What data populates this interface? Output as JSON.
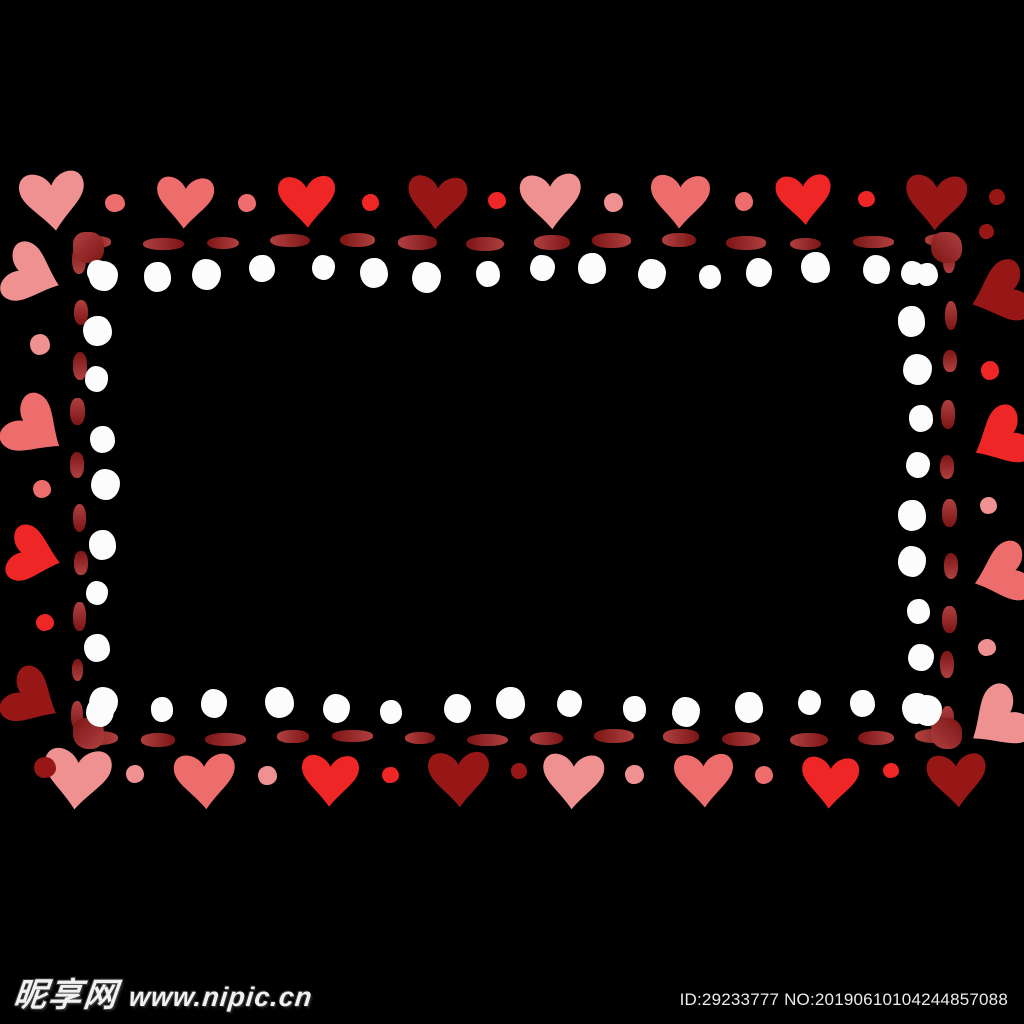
{
  "canvas": {
    "width": 1024,
    "height": 1024,
    "background": "#000000"
  },
  "palette": {
    "pink": "#f09191",
    "salmon": "#ed6c6c",
    "red": "#ee2626",
    "darkred": "#971717",
    "dash_light": "#b04040",
    "dash_dark": "#7c1515",
    "white_dot": "#fcfcfc"
  },
  "frame": {
    "hearts": [
      {
        "x": 53,
        "y": 202,
        "s": 66,
        "r": -6,
        "c": "pink"
      },
      {
        "x": 185,
        "y": 203,
        "s": 58,
        "r": 3,
        "c": "salmon"
      },
      {
        "x": 307,
        "y": 202,
        "s": 58,
        "r": -2,
        "c": "red"
      },
      {
        "x": 437,
        "y": 203,
        "s": 60,
        "r": 4,
        "c": "darkred"
      },
      {
        "x": 551,
        "y": 202,
        "s": 62,
        "r": -3,
        "c": "pink"
      },
      {
        "x": 680,
        "y": 202,
        "s": 60,
        "r": 2,
        "c": "salmon"
      },
      {
        "x": 804,
        "y": 200,
        "s": 56,
        "r": -4,
        "c": "red"
      },
      {
        "x": 936,
        "y": 203,
        "s": 62,
        "r": 3,
        "c": "darkred"
      },
      {
        "x": 77,
        "y": 780,
        "s": 68,
        "r": 5,
        "c": "pink"
      },
      {
        "x": 205,
        "y": 782,
        "s": 62,
        "r": -3,
        "c": "salmon"
      },
      {
        "x": 330,
        "y": 781,
        "s": 58,
        "r": 2,
        "c": "red"
      },
      {
        "x": 459,
        "y": 780,
        "s": 62,
        "r": -2,
        "c": "darkred"
      },
      {
        "x": 573,
        "y": 782,
        "s": 62,
        "r": 3,
        "c": "pink"
      },
      {
        "x": 704,
        "y": 781,
        "s": 60,
        "r": -2,
        "c": "salmon"
      },
      {
        "x": 830,
        "y": 783,
        "s": 58,
        "r": 3,
        "c": "red"
      },
      {
        "x": 957,
        "y": 781,
        "s": 60,
        "r": -4,
        "c": "darkred"
      },
      {
        "x": 33,
        "y": 276,
        "s": 62,
        "r": -70,
        "c": "pink"
      },
      {
        "x": 36,
        "y": 430,
        "s": 64,
        "r": -55,
        "c": "salmon"
      },
      {
        "x": 35,
        "y": 556,
        "s": 58,
        "r": -75,
        "c": "red"
      },
      {
        "x": 33,
        "y": 700,
        "s": 60,
        "r": -60,
        "c": "darkred"
      },
      {
        "x": 999,
        "y": 295,
        "s": 64,
        "r": 70,
        "c": "darkred"
      },
      {
        "x": 1000,
        "y": 440,
        "s": 62,
        "r": 62,
        "c": "red"
      },
      {
        "x": 1001,
        "y": 575,
        "s": 62,
        "r": 72,
        "c": "salmon"
      },
      {
        "x": 997,
        "y": 722,
        "s": 66,
        "r": 55,
        "c": "pink"
      }
    ],
    "accent_dots": [
      {
        "x": 115,
        "y": 204,
        "d": 20,
        "c": "salmon"
      },
      {
        "x": 247,
        "y": 203,
        "d": 18,
        "c": "salmon"
      },
      {
        "x": 370,
        "y": 202,
        "d": 17,
        "c": "red"
      },
      {
        "x": 497,
        "y": 201,
        "d": 18,
        "c": "red"
      },
      {
        "x": 613,
        "y": 202,
        "d": 19,
        "c": "pink"
      },
      {
        "x": 744,
        "y": 201,
        "d": 18,
        "c": "salmon"
      },
      {
        "x": 866,
        "y": 199,
        "d": 17,
        "c": "red"
      },
      {
        "x": 997,
        "y": 197,
        "d": 16,
        "c": "darkred"
      },
      {
        "x": 986,
        "y": 231,
        "d": 15,
        "c": "darkred"
      },
      {
        "x": 45,
        "y": 768,
        "d": 22,
        "c": "darkred"
      },
      {
        "x": 135,
        "y": 774,
        "d": 18,
        "c": "pink"
      },
      {
        "x": 267,
        "y": 775,
        "d": 19,
        "c": "pink"
      },
      {
        "x": 390,
        "y": 775,
        "d": 17,
        "c": "red"
      },
      {
        "x": 519,
        "y": 771,
        "d": 16,
        "c": "darkred"
      },
      {
        "x": 634,
        "y": 774,
        "d": 19,
        "c": "pink"
      },
      {
        "x": 764,
        "y": 775,
        "d": 18,
        "c": "salmon"
      },
      {
        "x": 891,
        "y": 771,
        "d": 16,
        "c": "red"
      },
      {
        "x": 40,
        "y": 344,
        "d": 20,
        "c": "pink"
      },
      {
        "x": 42,
        "y": 489,
        "d": 18,
        "c": "salmon"
      },
      {
        "x": 45,
        "y": 623,
        "d": 18,
        "c": "red"
      },
      {
        "x": 990,
        "y": 370,
        "d": 18,
        "c": "red"
      },
      {
        "x": 988,
        "y": 505,
        "d": 17,
        "c": "pink"
      },
      {
        "x": 987,
        "y": 648,
        "d": 18,
        "c": "pink"
      }
    ],
    "dashed_border": {
      "thickness": 14,
      "dash_len_h": 38,
      "dash_len_v": 27,
      "edges": [
        {
          "orient": "h",
          "y": 242,
          "from": 96,
          "to": 938,
          "count": 14
        },
        {
          "orient": "h",
          "y": 738,
          "from": 96,
          "to": 938,
          "count": 14
        },
        {
          "orient": "v",
          "x": 79,
          "from": 262,
          "to": 718,
          "count": 10
        },
        {
          "orient": "v",
          "x": 949,
          "from": 262,
          "to": 718,
          "count": 10
        }
      ],
      "corners": [
        {
          "x": 88,
          "y": 247
        },
        {
          "x": 946,
          "y": 247
        },
        {
          "x": 88,
          "y": 733
        },
        {
          "x": 946,
          "y": 733
        }
      ]
    },
    "white_dots": {
      "diameter": 27,
      "rows": [
        {
          "orient": "h",
          "y": 271,
          "from": 98,
          "to": 928,
          "count": 16
        },
        {
          "orient": "h",
          "y": 706,
          "from": 100,
          "to": 925,
          "count": 15
        },
        {
          "orient": "v",
          "x": 101,
          "from": 275,
          "to": 700,
          "count": 9
        },
        {
          "orient": "v",
          "x": 916,
          "from": 272,
          "to": 706,
          "count": 10
        }
      ]
    }
  },
  "watermark": {
    "site_name": "昵享网",
    "site_url": "www.nipic.cn",
    "id_text": "ID:29233777 NO:20190610104244857088"
  }
}
